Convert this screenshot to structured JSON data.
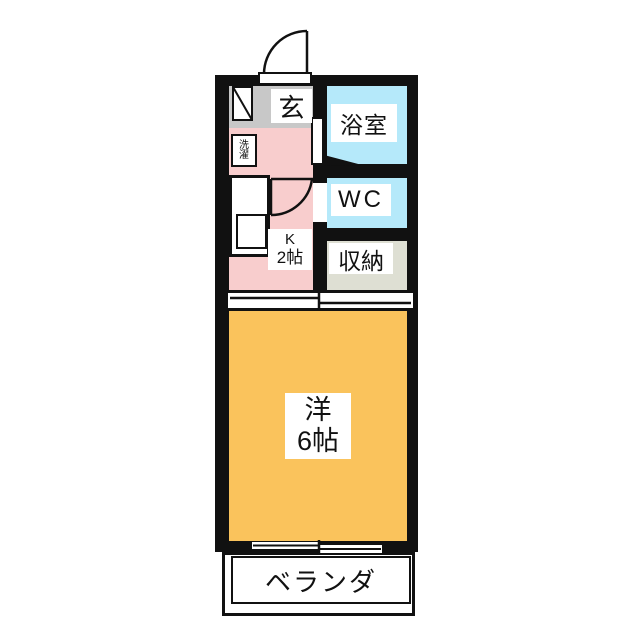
{
  "plan": {
    "type": "apartment-floor-plan",
    "rooms": {
      "genkan": {
        "label": "玄"
      },
      "bathroom": {
        "label": "浴室"
      },
      "toilet": {
        "label": "WC"
      },
      "storage": {
        "label": "収納"
      },
      "kitchen": {
        "label_line1": "K",
        "label_line2": "2帖"
      },
      "laundry": {
        "label_line1": "洗",
        "label_line2": "濯"
      },
      "western_room": {
        "label_line1": "洋",
        "label_line2": "6帖"
      },
      "veranda": {
        "label": "ベランダ"
      }
    },
    "colors": {
      "wall": "#111111",
      "genkan": "#c8c8c8",
      "kitchen": "#f8cdcd",
      "bathroom": "#b5e9fa",
      "toilet": "#b5e9fa",
      "storage": "#dedfd3",
      "western_room": "#fac35c",
      "label_background": "#ffffff"
    }
  }
}
